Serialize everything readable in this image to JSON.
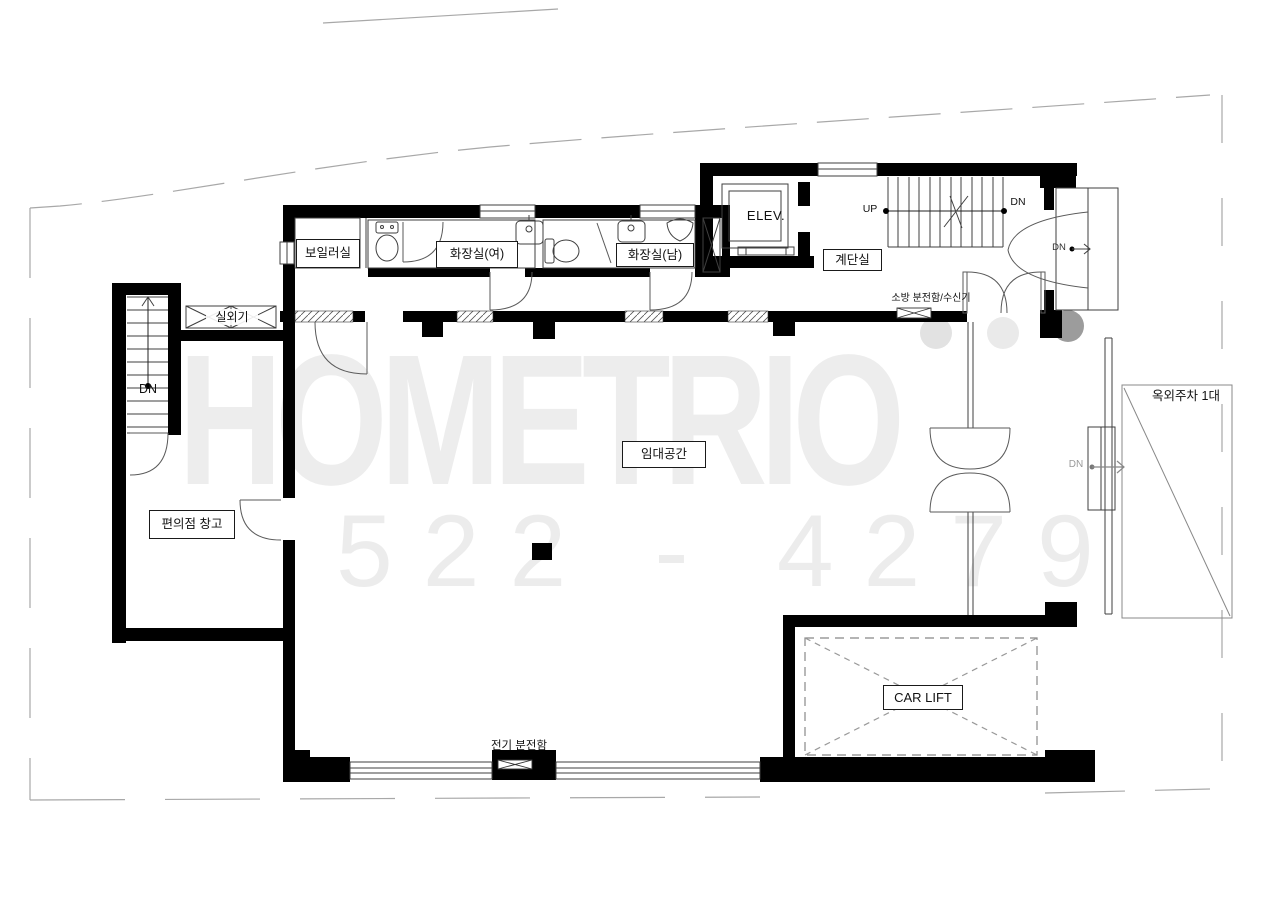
{
  "watermark": {
    "logo": "HOMETRIO",
    "phone": "522 - 4279"
  },
  "rooms": {
    "boiler": "보일러실",
    "toilet_women": "화장실(여)",
    "toilet_men": "화장실(남)",
    "elevator": "ELEV.",
    "stairwell": "계단실",
    "rental": "임대공간",
    "store_warehouse": "편의점 창고",
    "car_lift": "CAR LIFT",
    "outdoor_unit": "실외기",
    "outdoor_parking": "옥외주차 1대"
  },
  "annotations": {
    "up": "UP",
    "dn": "DN",
    "fire_panel": "소방 분전함/수신기",
    "electric_panel": "전기 분전함"
  },
  "colors": {
    "wall": "#000000",
    "line": "#3f3f3f",
    "watermark": "#ededed"
  }
}
